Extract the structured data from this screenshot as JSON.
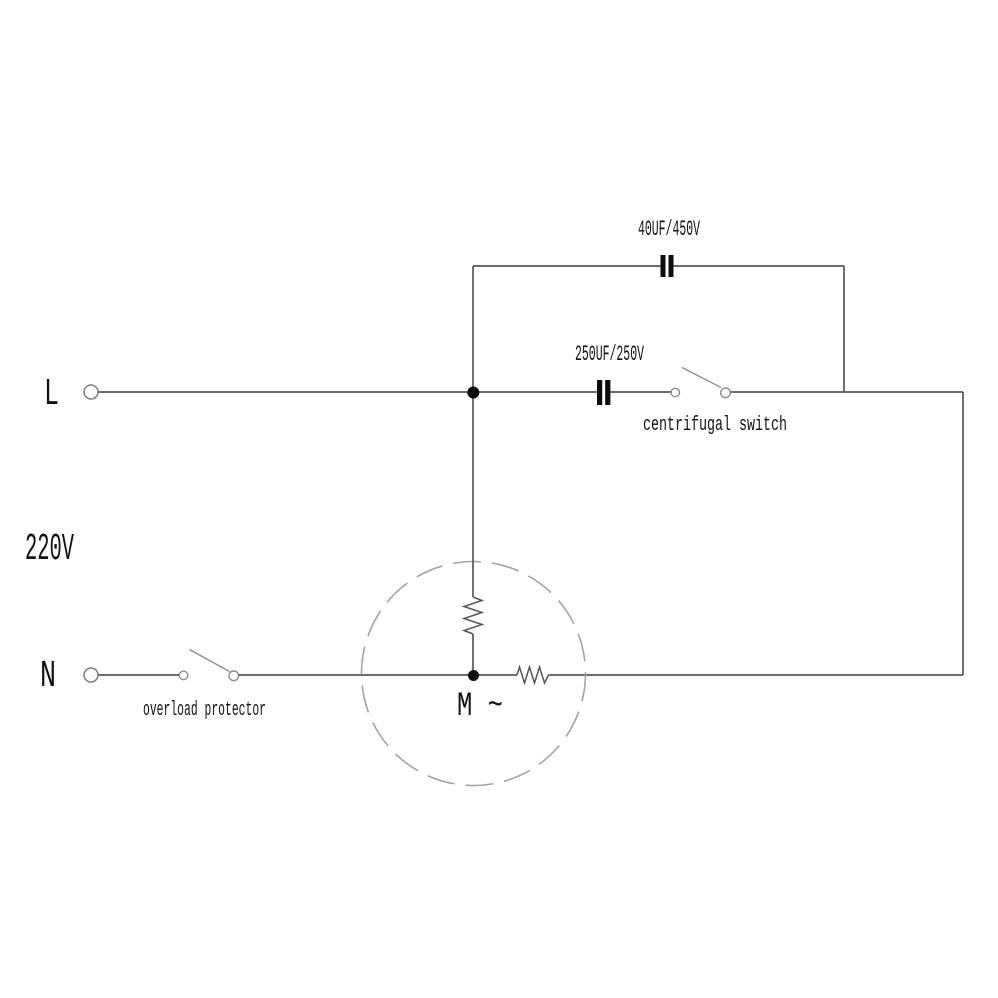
{
  "diagram": {
    "power": {
      "live_label": "L",
      "neutral_label": "N",
      "voltage_label": "220V"
    },
    "components": {
      "run_capacitor": {
        "label": "40UF/450V"
      },
      "start_capacitor": {
        "label": "250UF/250V"
      },
      "centrifugal_switch": {
        "label": "centrifugal switch"
      },
      "overload_protector": {
        "label": "overload protector"
      },
      "motor": {
        "label": "M ~"
      }
    },
    "colors": {
      "wire": "#565656",
      "component_ink": "#0d0d0d",
      "contact_outline": "#8c8c8c",
      "motor_outline": "#a3a3a3",
      "text": "#111111",
      "background": "#ffffff"
    }
  }
}
